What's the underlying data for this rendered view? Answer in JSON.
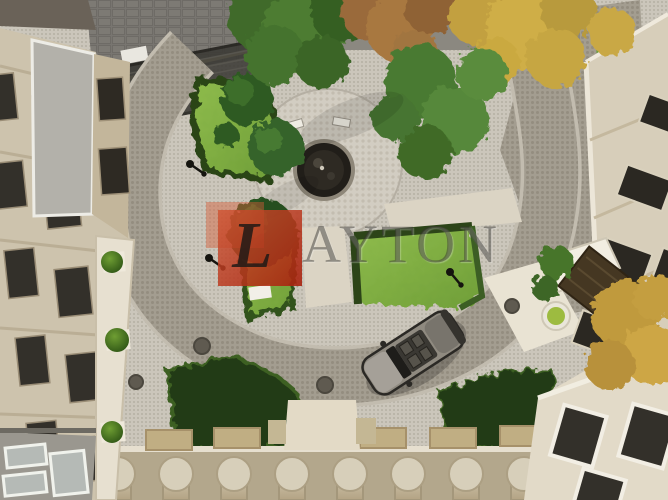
{
  "watermark": {
    "logo_letter": "L",
    "wordmark_rest": "AYTON",
    "full_brand": "LAYTON",
    "logo_color": "#c1391d"
  },
  "scene": {
    "type": "aerial-courtyard-architectural-render",
    "palette": {
      "pavement_light": "#cbc6bb",
      "road_grey": "#a39d90",
      "plaza_light": "#d2cdc2",
      "lawn_green": "#7fae3f",
      "hedge_dark": "#2c4418",
      "evergreen": "#35632a",
      "autumn_brown": "#a87840",
      "autumn_yellow": "#cfae46",
      "facade_cream": "#d6ccb6",
      "window_dark": "#2e2b24",
      "car_body": "#8f8a80"
    },
    "elements": [
      "left-building",
      "right-building",
      "bottom-building-colonnade",
      "corner-building",
      "ring-road",
      "central-plaza",
      "fountain",
      "benches",
      "lawn-wedges",
      "hedge-beds",
      "evergreen-trees",
      "autumn-trees",
      "parked-car",
      "street-lamps",
      "manhole-covers",
      "entrance-walkways",
      "planter-bushes",
      "pergola",
      "awning"
    ]
  }
}
